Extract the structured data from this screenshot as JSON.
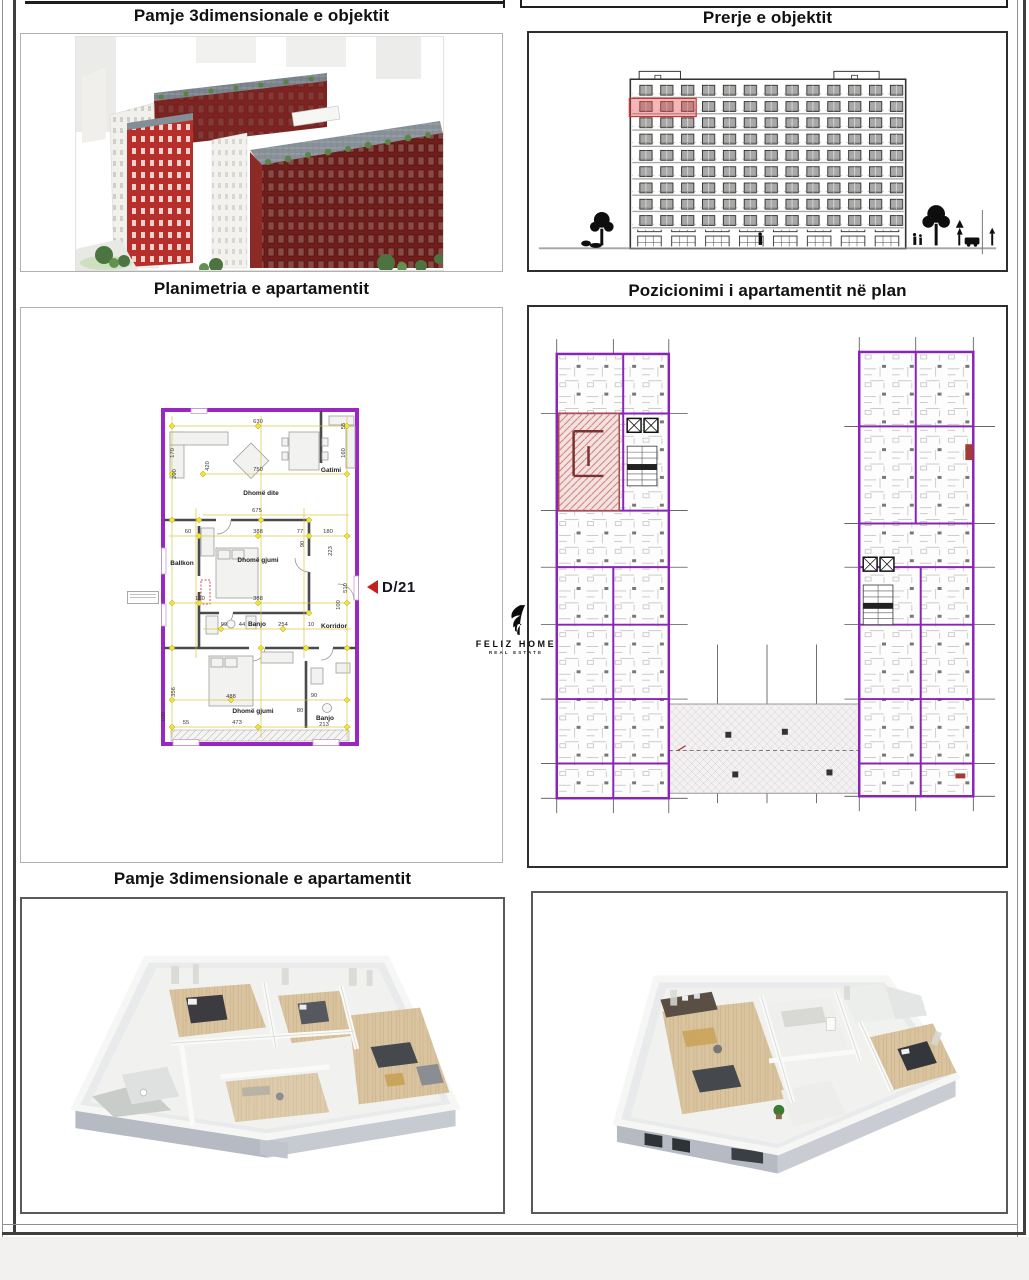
{
  "titles": {
    "top_left": "Pamje 3dimensionale e objektit",
    "top_right": "Prerje e objektit",
    "mid_left": "Planimetria e apartamentit",
    "mid_right": "Pozicionimi i apartamentit në plan",
    "bottom_left": "Pamje 3dimensionale e apartamentit"
  },
  "logo": {
    "name": "FELIZ HOME",
    "subtitle": "REAL ESTATE"
  },
  "floorplan": {
    "unit_label": "D/21",
    "rooms": [
      {
        "t": "Dhomë dite",
        "x": 100,
        "y": 86
      },
      {
        "t": "Gatimi",
        "x": 170,
        "y": 63
      },
      {
        "t": "Ballkon",
        "x": 21,
        "y": 156
      },
      {
        "t": "Dhomë gjumi",
        "x": 97,
        "y": 153
      },
      {
        "t": "Banjo",
        "x": 96,
        "y": 217
      },
      {
        "t": "Korridor",
        "x": 173,
        "y": 219
      },
      {
        "t": "Dhomë gjumi",
        "x": 92,
        "y": 304
      },
      {
        "t": "Banjo",
        "x": 164,
        "y": 311
      }
    ],
    "dims": [
      {
        "t": "630",
        "x": 97,
        "y": 15
      },
      {
        "t": "55",
        "x": 184,
        "y": 18,
        "r": 1
      },
      {
        "t": "170",
        "x": 13,
        "y": 45,
        "r": 1
      },
      {
        "t": "420",
        "x": 48,
        "y": 58,
        "r": 1
      },
      {
        "t": "750",
        "x": 97,
        "y": 63
      },
      {
        "t": "200",
        "x": 15,
        "y": 66,
        "r": 1
      },
      {
        "t": "675",
        "x": 96,
        "y": 104
      },
      {
        "t": "160",
        "x": 184,
        "y": 45,
        "r": 1
      },
      {
        "t": "60",
        "x": 27,
        "y": 125
      },
      {
        "t": "388",
        "x": 97,
        "y": 125
      },
      {
        "t": "77",
        "x": 139,
        "y": 125
      },
      {
        "t": "180",
        "x": 167,
        "y": 125
      },
      {
        "t": "223",
        "x": 171,
        "y": 143,
        "r": 1
      },
      {
        "t": "90",
        "x": 143,
        "y": 136,
        "r": 1
      },
      {
        "t": "130",
        "x": 39,
        "y": 192
      },
      {
        "t": "388",
        "x": 97,
        "y": 192
      },
      {
        "t": "510",
        "x": 186,
        "y": 180,
        "r": 1
      },
      {
        "t": "100",
        "x": 179,
        "y": 197,
        "r": 1
      },
      {
        "t": "99",
        "x": 63,
        "y": 218
      },
      {
        "t": "44",
        "x": 81,
        "y": 218
      },
      {
        "t": "254",
        "x": 122,
        "y": 218
      },
      {
        "t": "10",
        "x": 150,
        "y": 218
      },
      {
        "t": "356",
        "x": 14,
        "y": 284,
        "r": 1
      },
      {
        "t": "488",
        "x": 70,
        "y": 290
      },
      {
        "t": "90",
        "x": 153,
        "y": 289
      },
      {
        "t": "80",
        "x": 139,
        "y": 304
      },
      {
        "t": "473",
        "x": 76,
        "y": 316
      },
      {
        "t": "213",
        "x": 163,
        "y": 318
      },
      {
        "t": "100",
        "x": 4,
        "y": 309,
        "r": 1
      },
      {
        "t": "55",
        "x": 25,
        "y": 316
      }
    ]
  },
  "colors": {
    "plan_accent_purple": "#9b27c2",
    "highlight_red": "#cf4440",
    "dim_marker_yellow": "#e9d83f",
    "building_red": "#b72f2a",
    "building_dark_red": "#6f1e1c"
  }
}
